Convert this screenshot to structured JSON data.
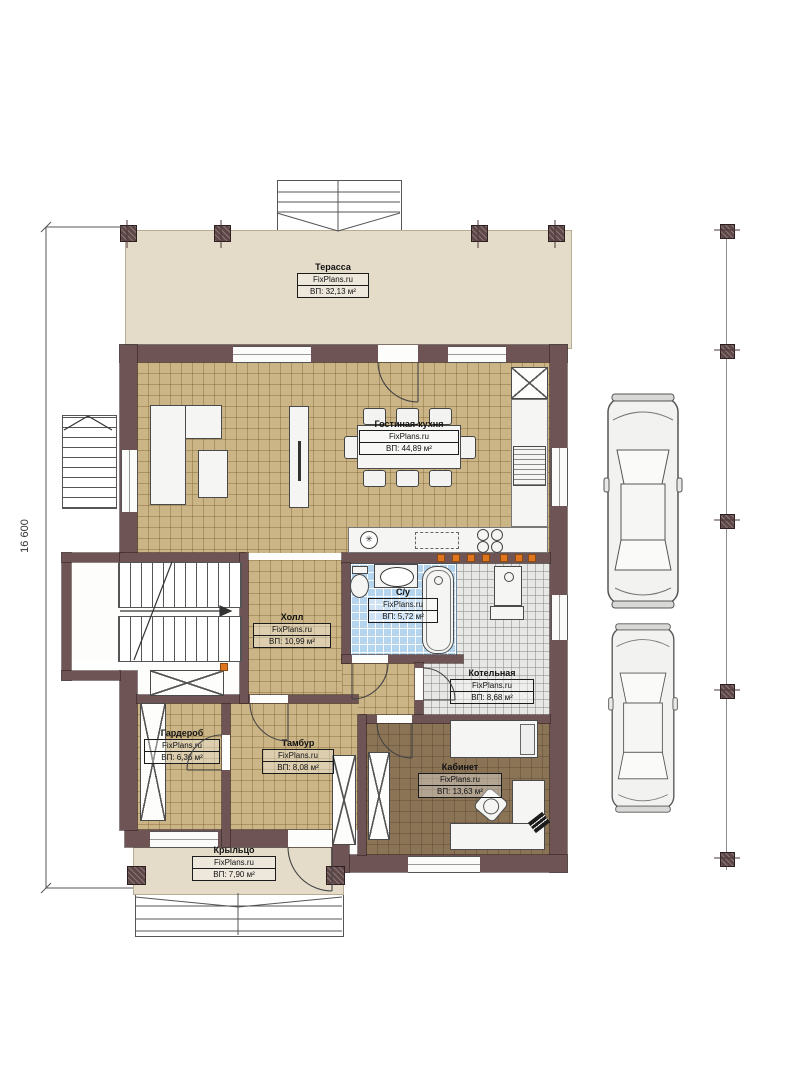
{
  "plan": {
    "dimension_left": "16 600",
    "brand": "FixPlans.ru"
  },
  "rooms": {
    "terrace": {
      "name": "Терасса",
      "brand": "FixPlans.ru",
      "area": "ВП: 32,13 м²"
    },
    "living_kitchen": {
      "name": "Гостиная-кухня",
      "brand": "FixPlans.ru",
      "area": "ВП: 44,89 м²"
    },
    "hall": {
      "name": "Холл",
      "brand": "FixPlans.ru",
      "area": "ВП: 10,99 м²"
    },
    "bathroom": {
      "name": "С/у",
      "brand": "FixPlans.ru",
      "area": "ВП: 5,72 м²"
    },
    "boiler": {
      "name": "Котельная",
      "brand": "FixPlans.ru",
      "area": "ВП: 8,68 м²"
    },
    "wardrobe": {
      "name": "Гардероб",
      "brand": "FixPlans.ru",
      "area": "ВП: 6,36 м²"
    },
    "vestibule": {
      "name": "Тамбур",
      "brand": "FixPlans.ru",
      "area": "ВП: 8,08 м²"
    },
    "office": {
      "name": "Кабинет",
      "brand": "FixPlans.ru",
      "area": "ВП: 13,63 м²"
    },
    "porch": {
      "name": "Крыльцо",
      "brand": "FixPlans.ru",
      "area": "ВП: 7,90 м²"
    }
  }
}
